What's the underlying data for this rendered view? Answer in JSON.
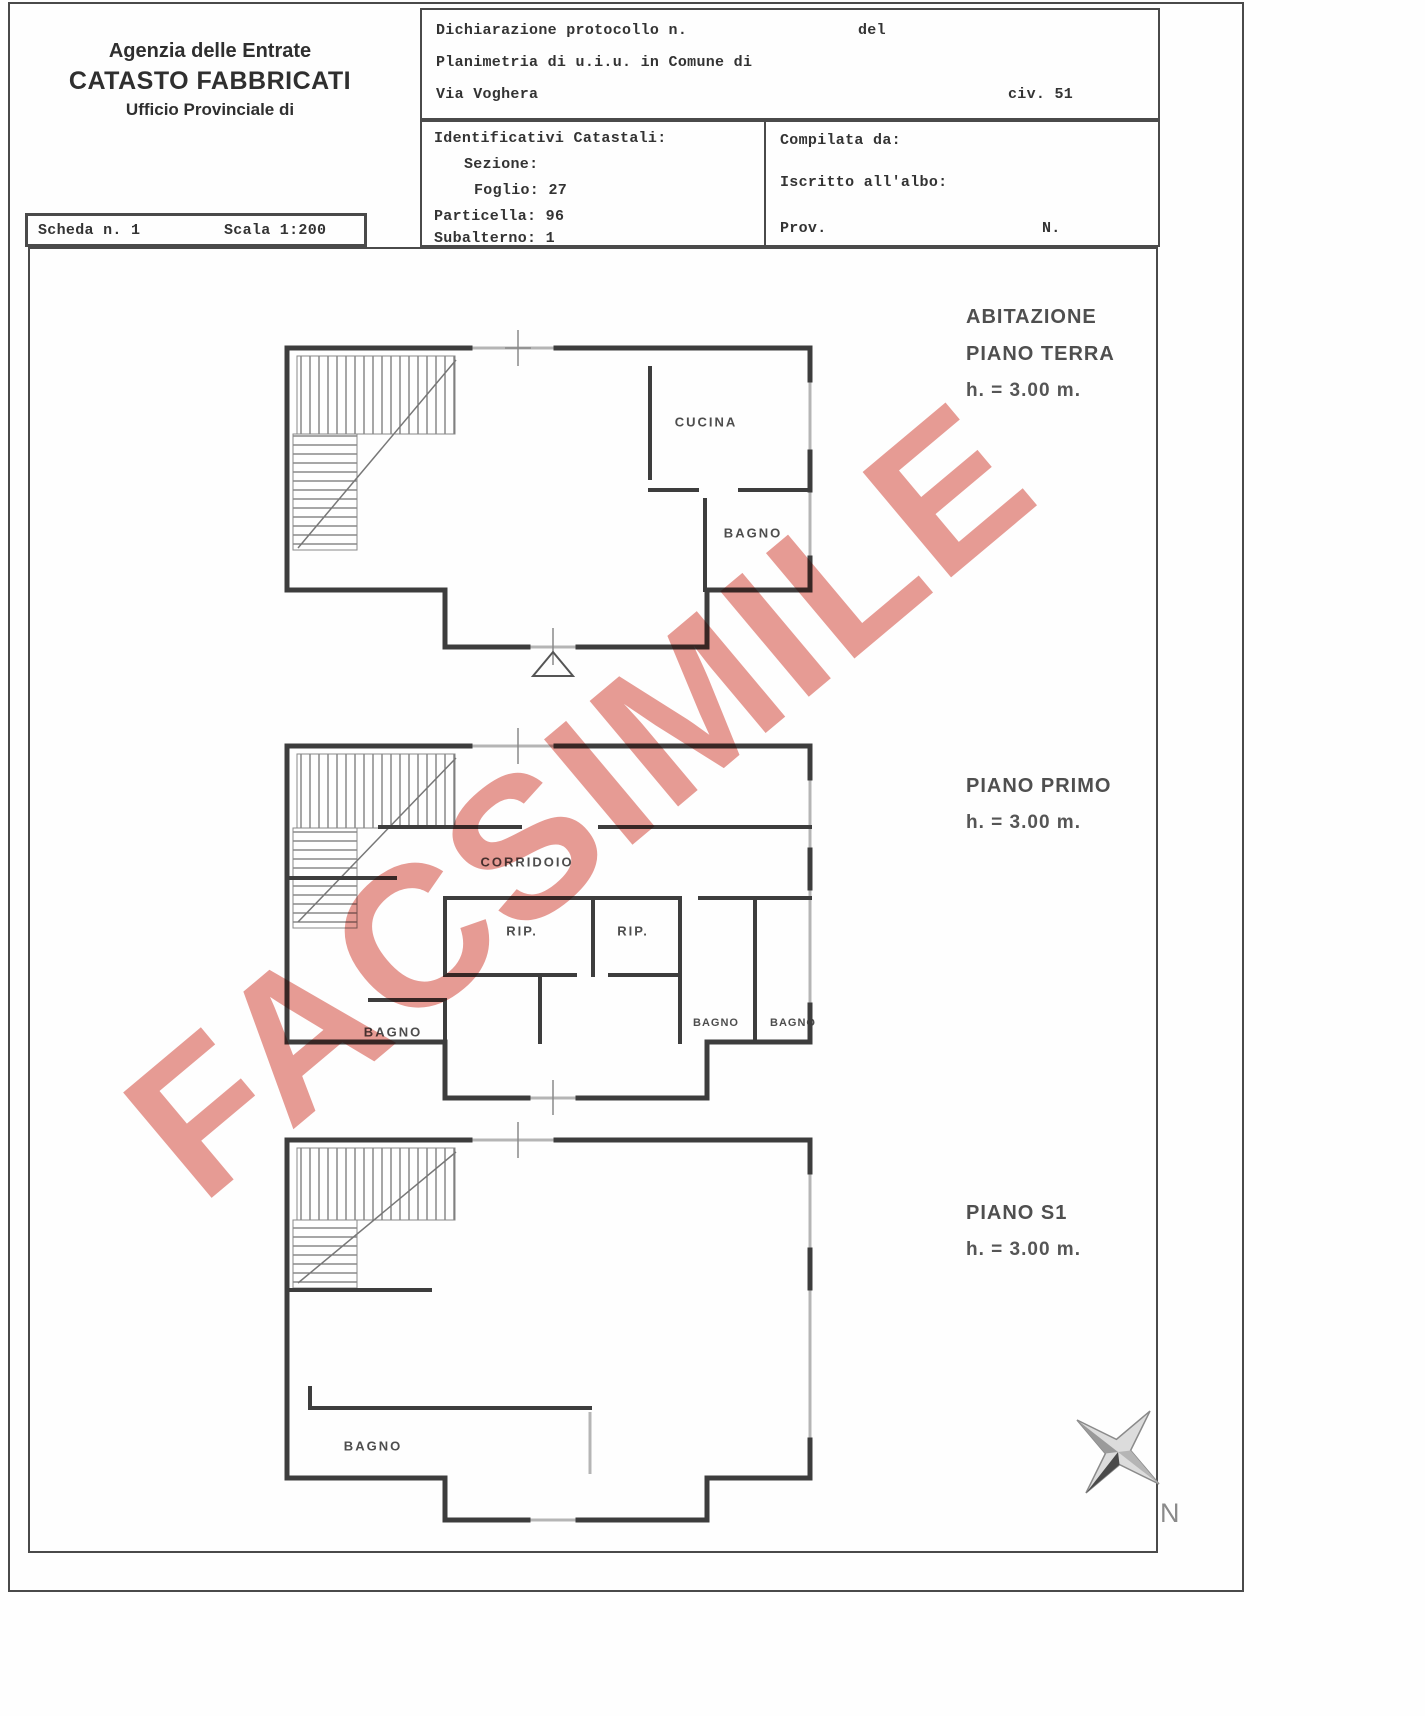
{
  "colors": {
    "watermark": "#e2867e",
    "wall": "#3d3d3d",
    "window": "#b5b5b5"
  },
  "watermark": "FACSIMILE",
  "agency": {
    "line1": "Agenzia delle Entrate",
    "line2": "CATASTO FABBRICATI",
    "line3": "Ufficio Provinciale di"
  },
  "declaration": {
    "line1_left": "Dichiarazione protocollo n.",
    "line1_right": "del",
    "line2": "Planimetria di u.i.u. in Comune di",
    "line3_left": "Via Voghera",
    "line3_right": "civ. 51"
  },
  "cadastral": {
    "title": "Identificativi Catastali:",
    "sezione_label": "Sezione:",
    "foglio_label": "Foglio:",
    "foglio_value": "27",
    "particella_label": "Particella:",
    "particella_value": "96",
    "subalterno_label": "Subalterno:",
    "subalterno_value": "1"
  },
  "compiled": {
    "compilata": "Compilata da:",
    "iscritto": "Iscritto all'albo:",
    "prov": "Prov.",
    "n": "N."
  },
  "scheda": {
    "left": "Scheda n. 1",
    "right": "Scala 1:200"
  },
  "floors": {
    "terra": {
      "l1": "ABITAZIONE",
      "l2": "PIANO TERRA",
      "h": "h. = 3.00 m."
    },
    "primo": {
      "l1": "PIANO PRIMO",
      "h": "h. = 3.00 m."
    },
    "s1": {
      "l1": "PIANO S1",
      "h": "h. = 3.00 m."
    }
  },
  "rooms": {
    "cucina": "CUCINA",
    "bagno_pt": "BAGNO",
    "corridoio": "CORRIDOIO",
    "rip1": "RIP.",
    "rip2": "RIP.",
    "bagno_p1": "BAGNO",
    "bagno_p1a": "BAGNO",
    "bagno_p1b": "BAGNO",
    "bagno_s1": "BAGNO"
  },
  "compass": {
    "label": "N"
  }
}
